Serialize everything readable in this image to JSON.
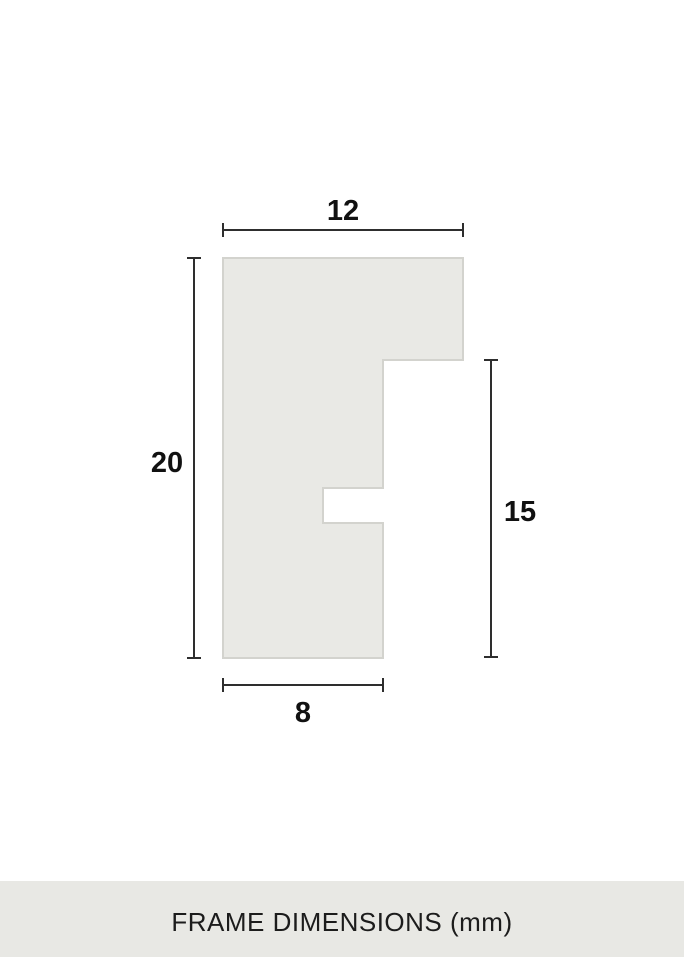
{
  "diagram": {
    "subject": "frame-profile-cross-section",
    "dimension_labels": {
      "top_width": "12",
      "left_height": "20",
      "right_height": "15",
      "bottom_width": "8"
    },
    "colors": {
      "background": "#ffffff",
      "profile_fill": "#e9e9e5",
      "profile_border": "#d3d3ce",
      "dimension_line": "#2e2e2e",
      "label_text": "#111111",
      "footer_bg": "#e8e8e4",
      "footer_text": "#1c1c1c"
    }
  },
  "footer": {
    "label": "FRAME DIMENSIONS (mm)"
  }
}
